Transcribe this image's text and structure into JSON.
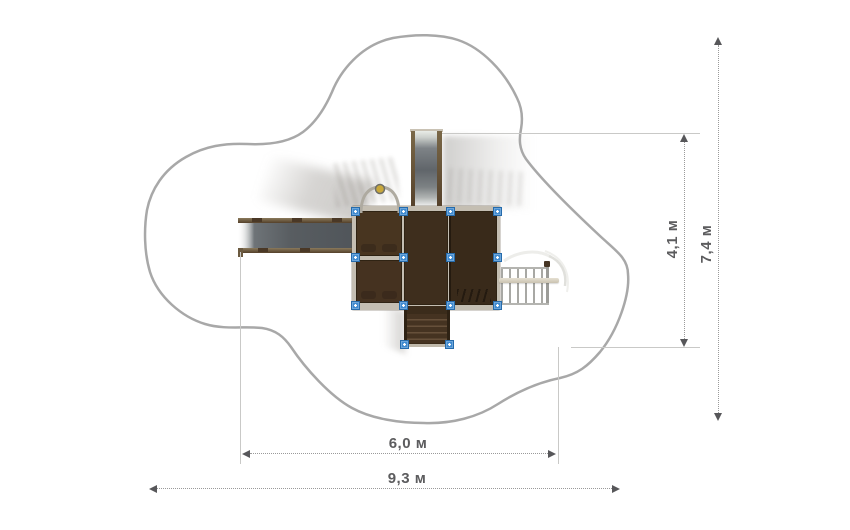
{
  "scene": {
    "title": "playground-equipment-top-view-plan",
    "background": "#ffffff"
  },
  "dimensions": {
    "equipment_height": {
      "label": "4,1 м"
    },
    "safety_zone_height": {
      "label": "7,4 м"
    },
    "equipment_width": {
      "label": "6,0 м"
    },
    "safety_zone_width": {
      "label": "9,3 м"
    }
  },
  "colors": {
    "safety_zone_outline": "#a8a8a8",
    "platform_frame": "#c4beb2",
    "platform_panel_dark": "#3e2e1d",
    "slide_surface": "#5d6266",
    "slide_rail": "#5a452d",
    "post_marker_blue": "#3d89cf",
    "dimension_line": "#9a9a9a",
    "dimension_text": "#5c5c5e",
    "arch_ball_yellow": "#c9a83b"
  },
  "components": [
    "safety-zone-outline",
    "side-slide",
    "top-slide",
    "main-platform",
    "arch-handle",
    "entry-stairs",
    "climbing-ladder",
    "spiral-rail",
    "post-markers"
  ]
}
